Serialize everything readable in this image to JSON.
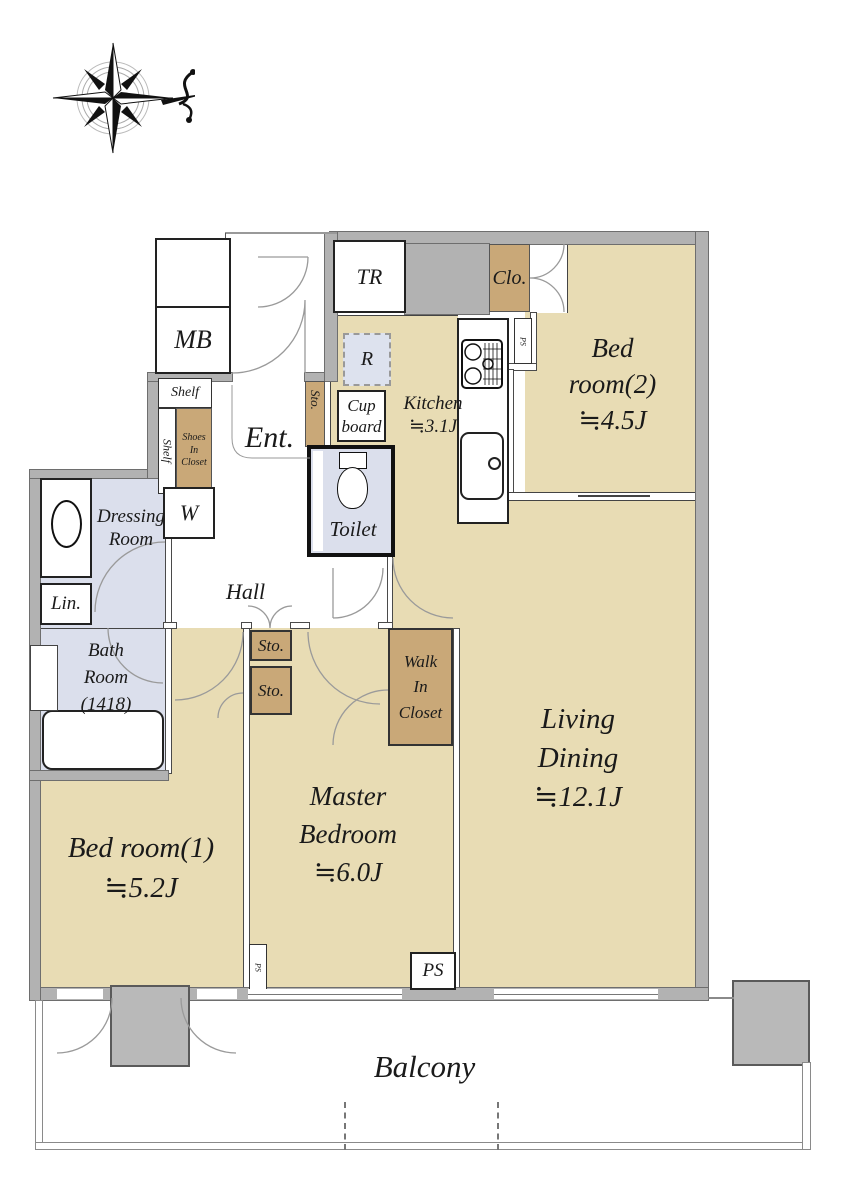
{
  "title": "apartment-floor-plan",
  "colors": {
    "floor_tan": "#e8dcb4",
    "closet_brown": "#c9a878",
    "wet_area_blue": "#dbdfec",
    "wall_gray": "#b2b2b2",
    "text": "#1a1a1a"
  },
  "compass": {
    "icon": "compass-rose-with-north-swash"
  },
  "labels": {
    "tr": "TR",
    "mb": "MB",
    "clo": "Clo.",
    "ps_top": "PS",
    "ps_narrow": "PS",
    "ps_big": "PS",
    "r": "R",
    "cup_1": "Cup",
    "cup_2": "board",
    "kitchen_1": "Kitchen",
    "kitchen_2": "≒3.1J",
    "bedroom2_1": "Bed",
    "bedroom2_2": "room(2)",
    "bedroom2_3": "≒4.5J",
    "ent": "Ent.",
    "shelf_top": "Shelf",
    "shelf_side": "Shelf",
    "shoes_1": "Shoes",
    "shoes_2": "In",
    "shoes_3": "Closet",
    "sto_ent": "Sto.",
    "toilet": "Toilet",
    "dressing_1": "Dressing",
    "dressing_2": "Room",
    "w": "W",
    "lin": "Lin.",
    "hall": "Hall",
    "bath_1": "Bath",
    "bath_2": "Room",
    "bath_3": "(1418)",
    "sto_1": "Sto.",
    "sto_2": "Sto.",
    "wic_1": "Walk",
    "wic_2": "In",
    "wic_3": "Closet",
    "bedroom1_1": "Bed room(1)",
    "bedroom1_2": "≒5.2J",
    "master_1": "Master",
    "master_2": "Bedroom",
    "master_3": "≒6.0J",
    "living_1": "Living",
    "living_2": "Dining",
    "living_3": "≒12.1J",
    "balcony": "Balcony"
  }
}
